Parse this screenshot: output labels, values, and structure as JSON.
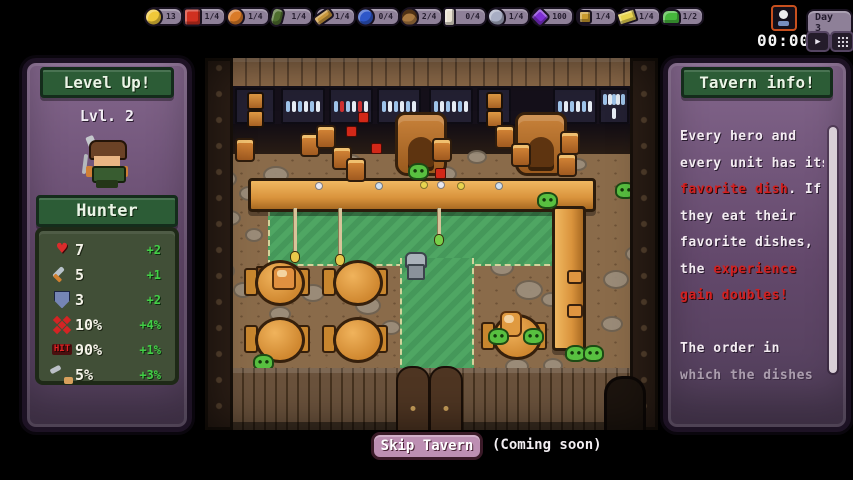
{
  "top_bar": {
    "items": [
      {
        "icon": "coin-icon",
        "count": "13",
        "color": "#f0c83a"
      },
      {
        "icon": "tomato-icon",
        "count": "1/4",
        "color": "#d03020"
      },
      {
        "icon": "pumpkin-icon",
        "count": "1/4",
        "color": "#d97b28"
      },
      {
        "icon": "eggplant-icon",
        "count": "1/4",
        "color": "#4e6e2e"
      },
      {
        "icon": "carrot-icon",
        "count": "1/4",
        "color": "#c9973b"
      },
      {
        "icon": "blueberry-icon",
        "count": "0/4",
        "color": "#2e57c8"
      },
      {
        "icon": "acorn-icon",
        "count": "2/4",
        "color": "#a87840"
      },
      {
        "icon": "milk-icon",
        "count": "0/4",
        "color": "#e9e2d2"
      },
      {
        "icon": "fish-icon",
        "count": "1/4",
        "color": "#a8aec4"
      },
      {
        "icon": "grape-icon",
        "count": "100",
        "color": "#7e2fd4"
      },
      {
        "icon": "gold-ore-icon",
        "count": "1/4",
        "color": "#c99b2f"
      },
      {
        "icon": "cheese-icon",
        "count": "1/4",
        "color": "#e8d44f"
      },
      {
        "icon": "frog-icon",
        "count": "1/2",
        "color": "#46b83c"
      }
    ]
  },
  "clock": {
    "day": "Day 3",
    "time": "00:00",
    "play_glyph": "▶"
  },
  "left_panel": {
    "title": "Level Up!",
    "level": "Lvl. 2",
    "unit": "Hunter",
    "stats": [
      {
        "icon": "health-icon",
        "value": "7",
        "bonus": "+2"
      },
      {
        "icon": "attack-icon",
        "value": "5",
        "bonus": "+1"
      },
      {
        "icon": "defense-icon",
        "value": "3",
        "bonus": "+2"
      },
      {
        "icon": "crit-icon",
        "value": "10%",
        "bonus": "+4%"
      },
      {
        "icon": "hit-icon",
        "icon_label": "HIT",
        "value": "90%",
        "bonus": "+1%"
      },
      {
        "icon": "dodge-icon",
        "value": "5%",
        "bonus": "+3%"
      }
    ]
  },
  "right_panel": {
    "title": "Tavern info!",
    "lines": [
      [
        {
          "t": "Every hero and",
          "c": "w"
        }
      ],
      [
        {
          "t": "every unit has its",
          "c": "w"
        }
      ],
      [
        {
          "t": "favorite dish",
          "c": "r"
        },
        {
          "t": ". If",
          "c": "w"
        }
      ],
      [
        {
          "t": "they eat their",
          "c": "w"
        }
      ],
      [
        {
          "t": "favorite dishes,",
          "c": "w"
        }
      ],
      [
        {
          "t": "the ",
          "c": "w"
        },
        {
          "t": "experience",
          "c": "r"
        }
      ],
      [
        {
          "t": "gain doubles!",
          "c": "r"
        }
      ],
      [
        {
          "t": "",
          "c": "w"
        }
      ],
      [
        {
          "t": "The order in",
          "c": "w"
        }
      ],
      [
        {
          "t": "which the dishes",
          "c": "w"
        }
      ]
    ]
  },
  "footer": {
    "skip_label": "Skip Tavern",
    "note": "(Coming soon)"
  },
  "colors": {
    "accent_green": "#42cf46",
    "warning_red": "#d32020",
    "panel_purple": "#63486b"
  }
}
